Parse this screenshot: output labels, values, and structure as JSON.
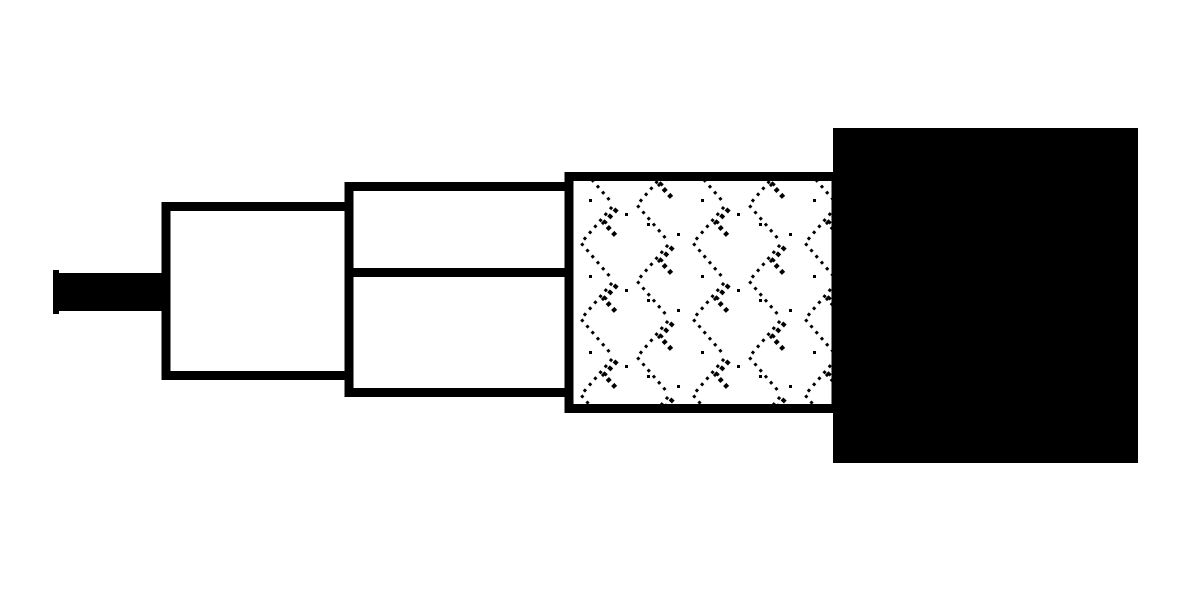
{
  "diagram": {
    "type": "coaxial-cable-cutaway",
    "background": "#ffffff",
    "colors": {
      "ink": "#000000",
      "paper": "#ffffff"
    },
    "parts": [
      {
        "name": "center-conductor",
        "shape": "solid-black-rod"
      },
      {
        "name": "conductor-end-cap",
        "shape": "small-tick"
      },
      {
        "name": "inner-insulation-layer",
        "shape": "white-outlined-box"
      },
      {
        "name": "outer-insulation-layer",
        "shape": "white-outlined-box-with-divider"
      },
      {
        "name": "insulation-divider-line",
        "shape": "horizontal-rule"
      },
      {
        "name": "braided-shield",
        "shape": "dotted-chevron-textured-box"
      },
      {
        "name": "outer-jacket",
        "shape": "solid-black-block"
      }
    ]
  }
}
